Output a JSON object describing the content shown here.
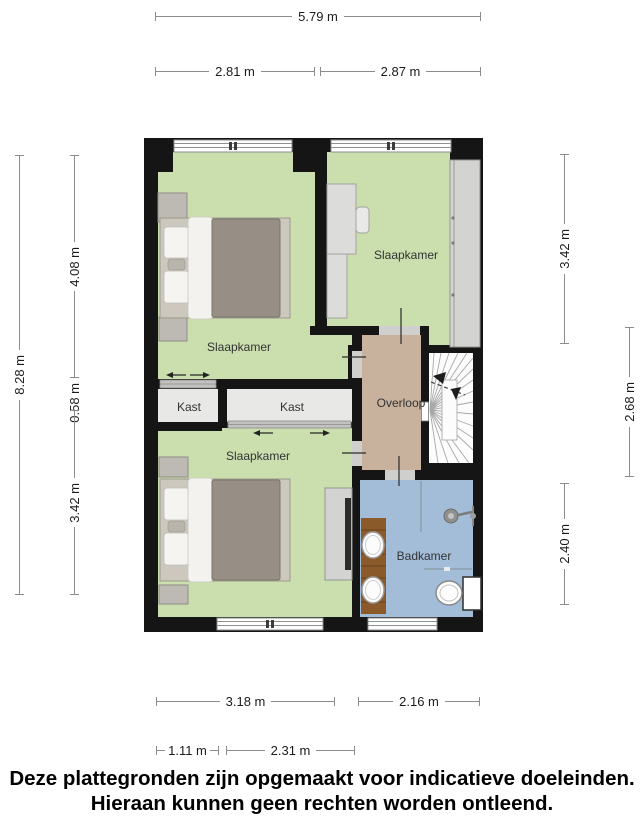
{
  "rooms": {
    "bedroom_top_left": {
      "label": "Slaapkamer"
    },
    "bedroom_top_right": {
      "label": "Slaapkamer"
    },
    "bedroom_bottom": {
      "label": "Slaapkamer"
    },
    "closet_left": {
      "label": "Kast"
    },
    "closet_right": {
      "label": "Kast"
    },
    "landing": {
      "label": "Overloop"
    },
    "bathroom": {
      "label": "Badkamer"
    }
  },
  "dims": {
    "top_total": {
      "label": "5.79 m"
    },
    "top_left": {
      "label": "2.81 m"
    },
    "top_right": {
      "label": "2.87 m"
    },
    "left_total": {
      "label": "8.28 m"
    },
    "left_top": {
      "label": "4.08 m"
    },
    "left_mid": {
      "label": "0.58 m"
    },
    "left_bottom": {
      "label": "3.42 m"
    },
    "right_top": {
      "label": "3.42 m"
    },
    "right_mid": {
      "label": "2.68 m"
    },
    "right_bottom": {
      "label": "2.40 m"
    },
    "bottom_left": {
      "label": "3.18 m"
    },
    "bottom_right": {
      "label": "2.16 m"
    },
    "bottom_sub_left": {
      "label": "1.11 m"
    },
    "bottom_sub_right": {
      "label": "2.31 m"
    }
  },
  "disclaimer": {
    "line1": "Deze plattegronden zijn opgemaakt voor indicatieve doeleinden.",
    "line2": "Hieraan kunnen geen rechten worden ontleend."
  },
  "colors": {
    "wall": "#151515",
    "room_floor": "#cbdfae",
    "landing_floor": "#c9b29d",
    "bathroom_floor": "#a3bcd8",
    "closet_floor": "#e8e8e6",
    "stairs_floor": "#fcfcfc",
    "vanity_wood": "#8a5a2b"
  }
}
